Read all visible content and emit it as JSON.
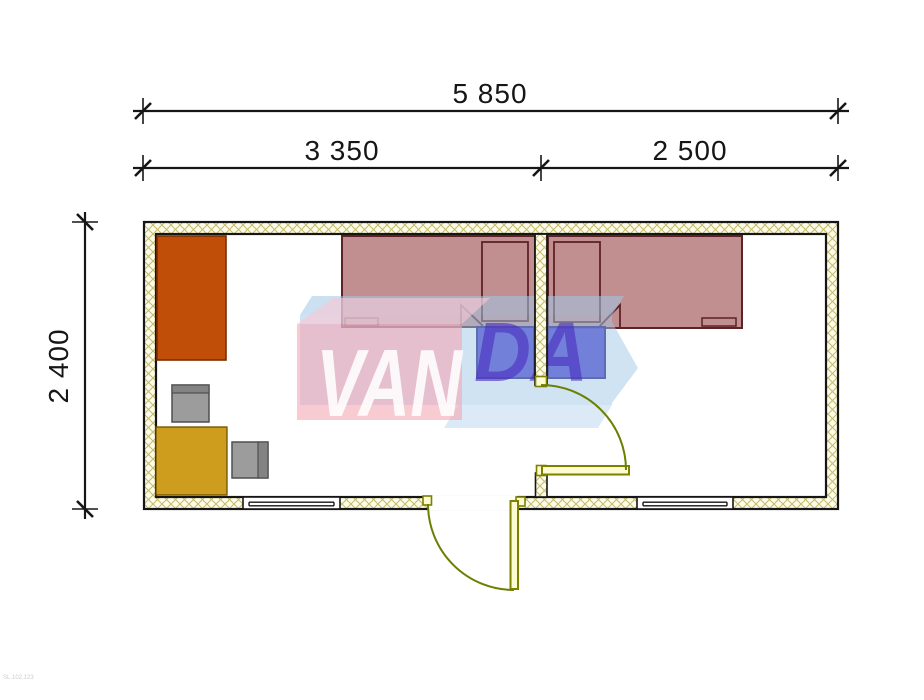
{
  "drawing": {
    "type": "floor-plan",
    "dimensions": {
      "overall_width": "5 850",
      "room_left_width": "3 350",
      "room_right_width": "2 500",
      "overall_depth": "2 400"
    },
    "watermark": {
      "text_primary": "VAN",
      "text_secondary": "DA"
    },
    "stamp_code": "SL.102.123",
    "rooms": [
      {
        "name": "room-left",
        "furniture": [
          "wardrobe",
          "desk",
          "chair-north",
          "chair-east",
          "bed",
          "nightstand"
        ],
        "openings": [
          "entrance-door",
          "window"
        ]
      },
      {
        "name": "room-right",
        "furniture": [
          "bed",
          "nightstand"
        ],
        "openings": [
          "interior-door",
          "window"
        ]
      }
    ],
    "colors": {
      "wall_hatch_bg": "#fcfce9",
      "wall_hatch_line": "#c6bd72",
      "wall_edge": "#161616",
      "wardrobe": "#c04e08",
      "wardrobe_outline": "#7c2d00",
      "desk": "#cf9d1d",
      "desk_outline": "#6b5200",
      "chair": "#9c9c9c",
      "chair_back": "#838383",
      "chair_outline": "#4f4f4f",
      "bed_fill": "#8f3337",
      "bed_outline": "#5d2226",
      "nightstand": "#3629c6",
      "nightstand_outline": "#1c1276",
      "door_leaf_fill": "#fcfcd2",
      "door_leaf_outline": "#7f7f00",
      "door_swing_arc": "#6b7f00",
      "dimension_line": "#161616",
      "watermark_pink": "#f4a6b4",
      "watermark_pink_top": "#f8c6d2",
      "watermark_blue": "#a0c8e8",
      "watermark_text_primary_color": "#ffffff",
      "watermark_text_secondary_color": "#4b2dbe"
    }
  }
}
